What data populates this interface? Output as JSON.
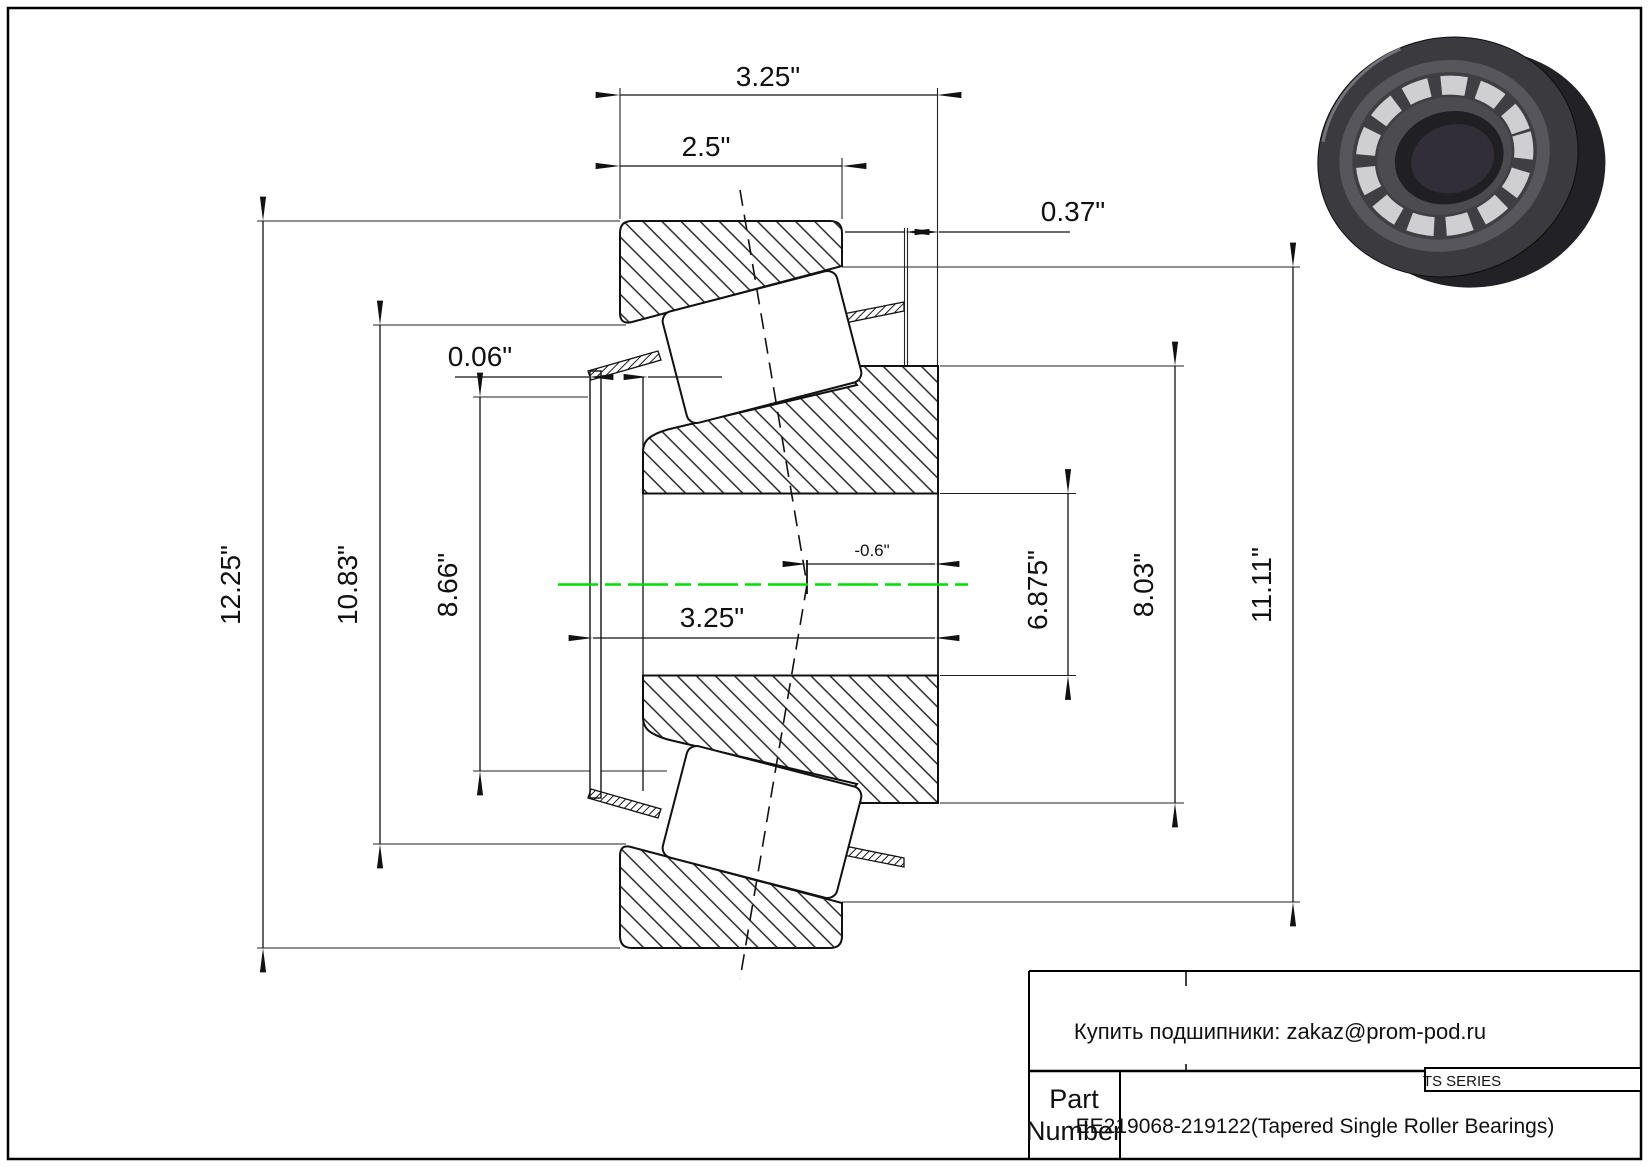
{
  "drawing": {
    "kind": "Tapered single roller bearing cross-section drawing",
    "dims": {
      "overall_width": "3.25\"",
      "cup_width": "2.5\"",
      "cage_standout": "0.37\"",
      "front_standout": "0.06\"",
      "cup_od": "12.25\"",
      "cage_od": "10.83\"",
      "seal_od": "8.66\"",
      "cone_width": "3.25\"",
      "eff_center": "-0.6\"",
      "bore": "6.875\"",
      "rib_od": "8.03\"",
      "raceway_od": "11.11\""
    },
    "colors": {
      "centerline_green": "#00dd00",
      "line_black": "#000000",
      "background": "#ffffff"
    }
  },
  "title_block": {
    "contact": "Купить подшипники: zakaz@prom-pod.ru",
    "series": "TS SERIES",
    "part_label_line1": "Part",
    "part_label_line2": "Number",
    "part_value": "EE219068-219122(Tapered Single Roller Bearings)"
  }
}
